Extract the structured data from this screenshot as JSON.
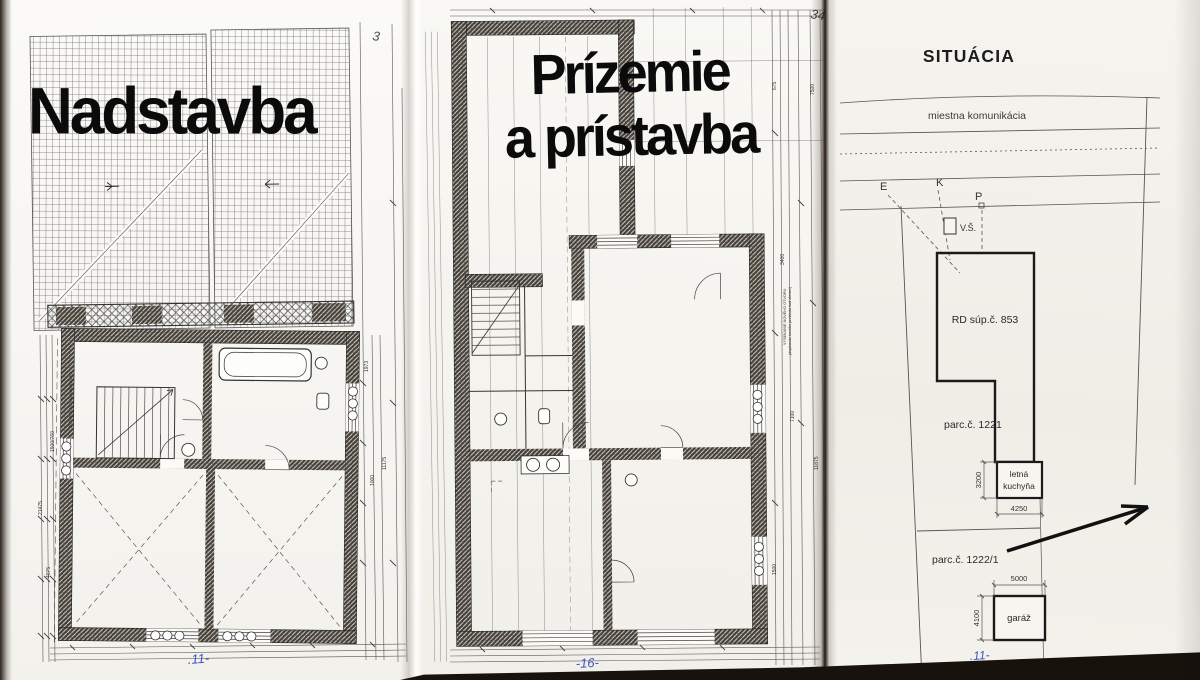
{
  "page1": {
    "title": "Nadstavba",
    "page_number": "3",
    "footer_mark": ".11-",
    "side_note": "ŽB PREKLAD (nad schodiskom)",
    "dim_labels": {
      "l1": "21475",
      "l2": "1500/760",
      "l3": "4075",
      "r1": "1973",
      "r2": "11175",
      "r3": "1000"
    }
  },
  "page2": {
    "title_line1": "Prízemie",
    "title_line2": "a prístavba",
    "page_number": "34",
    "footer_mark": "-16-",
    "side_note_1": "VYSEKANIE NOVÉHO OTVORU",
    "side_note_2": "(doplnenie nového prekladu nad oknom)",
    "dim_labels": {
      "a": "675",
      "b": "3400",
      "c": "7100",
      "d": "1500",
      "e": "7500",
      "f": "11875"
    }
  },
  "page3": {
    "title": "SITUÁCIA",
    "road_label": "miestna komunikácia",
    "marker_e": "E",
    "marker_k": "K",
    "marker_p": "P",
    "shaft_label": "V.Š.",
    "house_label": "RD súp.č. 853",
    "parcel1_label": "parc.č. 1221",
    "parcel2_label": "parc.č. 1222/1",
    "kitchen_line1": "letná",
    "kitchen_line2": "kuchyňa",
    "kitchen_width": "4250",
    "kitchen_depth": "3200",
    "garage_label": "garáž",
    "garage_width": "5000",
    "garage_depth": "4100",
    "footer_mark": ".11-"
  },
  "colors": {
    "paper": "#f5f3ee",
    "ink": "#2b2b2b",
    "wall_fill": "#3f3b36",
    "handwriting_blue": "#3d55c4",
    "scan_edge": "#17120c"
  }
}
